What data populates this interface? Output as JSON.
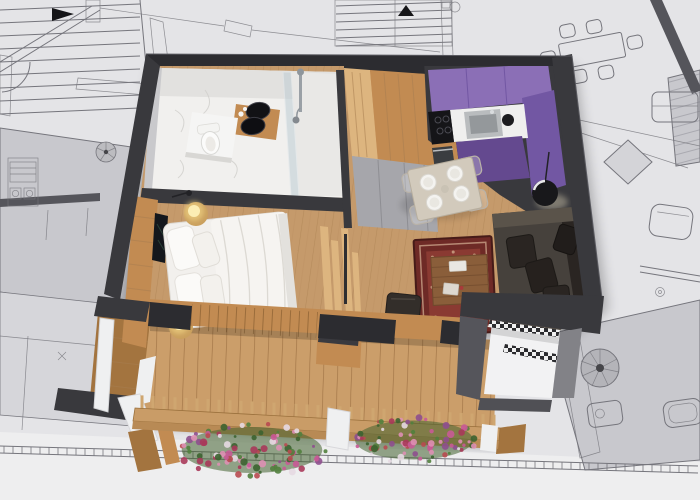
{
  "meta": {
    "kind": "architectural-visualization",
    "description": "Top-down 3D cut-away render of a one-bedroom apartment placed over a 2D architectural blueprint drawing",
    "visible_text": "none"
  },
  "colors": {
    "paper": "#e4e4e7",
    "paperLight": "#eeeeef",
    "paperShadeDark": "#c8c8cd",
    "paperShadeMid": "#d6d6da",
    "blueline": "#75757c",
    "hatchLine": "#6e6e74",
    "wallDark": "#39393d",
    "wallDarker": "#2c2c30",
    "wallMid": "#55555b",
    "woodFloor": "#c59a6b",
    "woodFloorLine": "#a87e50",
    "woodWarm": "#c28b52",
    "woodLight": "#ddb57f",
    "woodDark": "#a3743f",
    "deck": "#cb9e6a",
    "purple": "#8b6fb6",
    "purpleDark": "#7257a3",
    "purpleDeep": "#64498f",
    "counter": "#efefee",
    "steel": "#b9bcbe",
    "black": "#151518",
    "marble": "#f1f0ee",
    "marbleShade": "#e2e1df",
    "white": "#f5f5f4",
    "bedWhite": "#f2f0ed",
    "bedFold": "#dcd9d3",
    "sofa": "#46413c",
    "sofaDark": "#2a2522",
    "sofaLight": "#5a534a",
    "rug": "#6e2a26",
    "rugField": "#8a3a32",
    "rugLight": "#c9a188",
    "tableTop": "#d2cabc",
    "ghost": "#b9b2a8",
    "glow": "#f7dc8a",
    "glowDeep": "#caa05e",
    "grayDoor": "#a6a6ab",
    "grayWedge": "#828287",
    "postWhite": "#eff0f1"
  },
  "scene": {
    "background": {
      "label": "gray architectural blueprint with stairs, hatched walls, furniture symbols"
    },
    "apartment": {
      "label": "3D apartment model",
      "rooms": [
        {
          "name": "bathroom",
          "features": [
            "marble floor",
            "toilet",
            "wood vanity with two black vessel sinks",
            "glass shower"
          ]
        },
        {
          "name": "bedroom",
          "features": [
            "double bed with white duvet",
            "wood headboard wall",
            "dark wall panel",
            "two glowing bedside lamps"
          ]
        },
        {
          "name": "kitchen",
          "features": [
            "purple cabinets",
            "white countertop",
            "black cooktop",
            "steel sink",
            "oven"
          ]
        },
        {
          "name": "dining-area",
          "features": [
            "square table with four place settings",
            "transparent chairs",
            "black floor lamp"
          ]
        },
        {
          "name": "living-area",
          "features": [
            "dark leather sofa with cushions",
            "red oriental rug",
            "wood coffee table",
            "dark pouf",
            "slat partition with bench"
          ]
        },
        {
          "name": "entrance",
          "features": [
            "white floor",
            "checkered tile strip",
            "dark walls"
          ]
        },
        {
          "name": "balcony",
          "features": [
            "wood deck planks",
            "wood railing with balusters",
            "white posts",
            "two flower boxes"
          ]
        }
      ]
    },
    "generators": {
      "stairs": [
        {
          "target": "stairs-top-left-lines",
          "x1": 0,
          "x2": 140,
          "y1": 10,
          "skew": -6,
          "step": 13,
          "count": 9
        },
        {
          "target": "stairs-top-center-lines",
          "x1": 336,
          "x2": 452,
          "y1": 6,
          "skew": -4,
          "step": 8,
          "count": 6
        }
      ],
      "ticks": {
        "target": "balcony-rail-blueprint-ticks",
        "x1": 4,
        "x2": 692,
        "step": 9,
        "y0": 446,
        "slope": 0.029,
        "len": 7
      },
      "balusters": {
        "target": "railing-balusters",
        "x1": 142,
        "x2": 494,
        "step": 11,
        "xref": 135,
        "y0": 410,
        "slope": 0.055,
        "len": 15
      },
      "flowers": {
        "target": "flower-layer",
        "palette": [
          "#c85a96",
          "#a8385a",
          "#e6d9e2",
          "#517f3d",
          "#8e4f8e",
          "#de8fb4",
          "#3c6330",
          "#b84a50"
        ],
        "clusters": [
          {
            "cx": 252,
            "cy": 450,
            "rx": 74,
            "ry": 27,
            "count": 95,
            "seed": 7
          },
          {
            "cx": 414,
            "cy": 440,
            "rx": 62,
            "ry": 23,
            "count": 75,
            "seed": 23
          }
        ]
      }
    }
  }
}
